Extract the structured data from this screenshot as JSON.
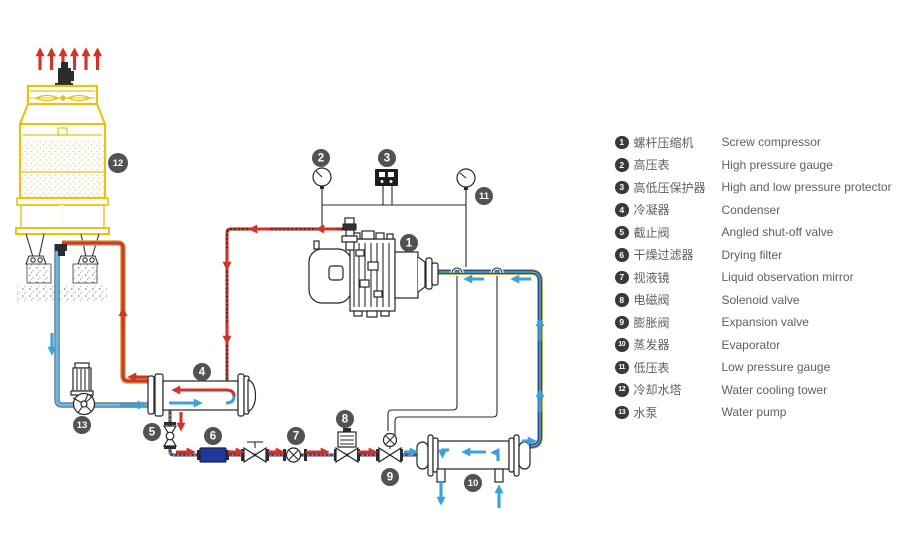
{
  "colors": {
    "red": "#d23228",
    "blue": "#3aa2dc",
    "navy": "#1d3a85",
    "yellow": "#e6c414",
    "cream": "#fdf7de",
    "filterblue": "#20389b",
    "badge": "#515254",
    "text": "#5e6063"
  },
  "legend": {
    "items": [
      {
        "num": "1",
        "zh": "螺杆压缩机",
        "en": "Screw compressor"
      },
      {
        "num": "2",
        "zh": "高压表",
        "en": "High pressure gauge"
      },
      {
        "num": "3",
        "zh": "高低压保护器",
        "en": "High and low pressure protector"
      },
      {
        "num": "4",
        "zh": "冷凝器",
        "en": "Condenser"
      },
      {
        "num": "5",
        "zh": "截止阀",
        "en": "Angled shut-off valve"
      },
      {
        "num": "6",
        "zh": "干燥过滤器",
        "en": "Drying filter"
      },
      {
        "num": "7",
        "zh": "视液镜",
        "en": "Liquid observation mirror"
      },
      {
        "num": "8",
        "zh": "电磁阀",
        "en": "Solenoid valve"
      },
      {
        "num": "9",
        "zh": "膨胀阀",
        "en": "Expansion valve"
      },
      {
        "num": "10",
        "zh": "蒸发器",
        "en": "Evaporator"
      },
      {
        "num": "11",
        "zh": "低压表",
        "en": "Low pressure gauge"
      },
      {
        "num": "12",
        "zh": "冷却水塔",
        "en": "Water cooling tower"
      },
      {
        "num": "13",
        "zh": "水泵",
        "en": "Water pump"
      }
    ]
  },
  "diagram": {
    "badges": [
      {
        "num": "1",
        "x": 409,
        "y": 243
      },
      {
        "num": "2",
        "x": 321,
        "y": 158
      },
      {
        "num": "3",
        "x": 387,
        "y": 158
      },
      {
        "num": "4",
        "x": 202,
        "y": 372
      },
      {
        "num": "5",
        "x": 152,
        "y": 432
      },
      {
        "num": "6",
        "x": 213,
        "y": 436
      },
      {
        "num": "7",
        "x": 296,
        "y": 436
      },
      {
        "num": "8",
        "x": 345,
        "y": 419
      },
      {
        "num": "9",
        "x": 390,
        "y": 477
      },
      {
        "num": "10",
        "x": 473,
        "y": 483
      },
      {
        "num": "11",
        "x": 484,
        "y": 196
      },
      {
        "num": "12",
        "x": 118,
        "y": 163,
        "r": 10
      },
      {
        "num": "13",
        "x": 82,
        "y": 425
      }
    ]
  }
}
